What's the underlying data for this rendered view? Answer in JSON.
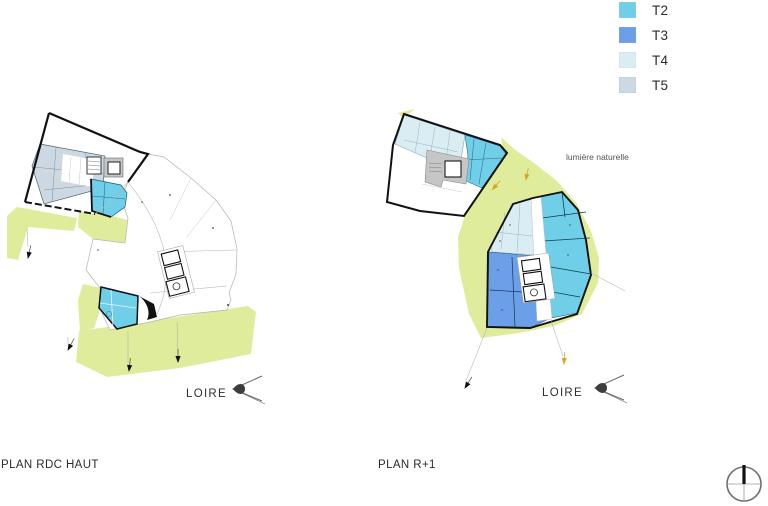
{
  "colors": {
    "t2": "#6fcfe9",
    "t3": "#6b9fe8",
    "t4": "#d9edf3",
    "t5": "#cdd9e2",
    "green": "#dfec9b",
    "core_gray": "#c6c6c6",
    "arrow_orange": "#d9a426",
    "outline_black": "#111111"
  },
  "legend": {
    "items": [
      {
        "label": "T2",
        "color": "#6fcfe9"
      },
      {
        "label": "T3",
        "color": "#6b9fe8"
      },
      {
        "label": "T4",
        "color": "#d9edf3"
      },
      {
        "label": "T5",
        "color": "#cdd9e2"
      }
    ]
  },
  "plans": {
    "left": {
      "title": "PLAN RDC HAUT",
      "river_label": "LOIRE"
    },
    "right": {
      "title": "PLAN R+1",
      "river_label": "LOIRE",
      "annotation": "lumière naturelle"
    }
  }
}
